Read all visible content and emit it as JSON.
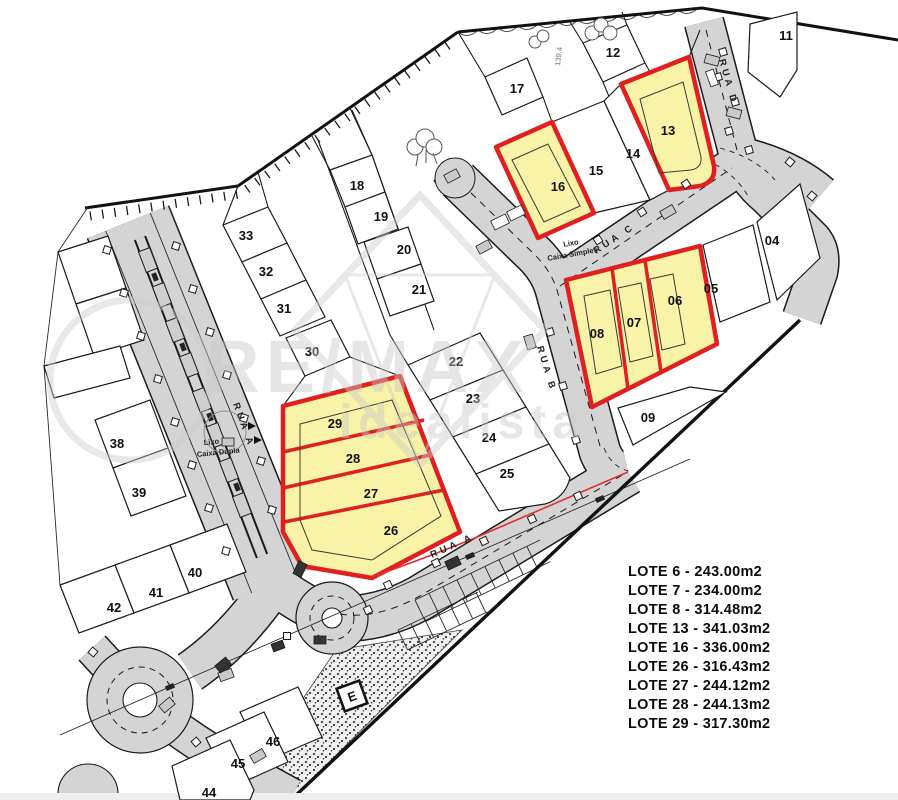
{
  "map": {
    "colors": {
      "highlight_fill": "#f8f3a6",
      "highlight_stroke": "#e02020",
      "road_fill": "#d4d4d4",
      "line": "#1b1b1b",
      "watermark": "#c9c9c9",
      "road_edge_red_line": "#e03030"
    },
    "lots": {
      "04": "04",
      "05": "05",
      "06": "06",
      "07": "07",
      "08": "08",
      "09": "09",
      "11": "11",
      "12": "12",
      "13": "13",
      "14": "14",
      "15": "15",
      "16": "16",
      "17": "17",
      "18": "18",
      "19": "19",
      "20": "20",
      "21": "21",
      "22": "22",
      "23": "23",
      "24": "24",
      "25": "25",
      "26": "26",
      "27": "27",
      "28": "28",
      "29": "29",
      "30": "30",
      "31": "31",
      "32": "32",
      "33": "33",
      "38": "38",
      "39": "39",
      "40": "40",
      "41": "41",
      "42": "42",
      "44": "44",
      "45": "45",
      "46": "46"
    },
    "highlighted_lots": [
      "06",
      "07",
      "08",
      "13",
      "16",
      "26",
      "27",
      "28",
      "29"
    ],
    "streets": {
      "rua_a": "RUA A",
      "rua_b": "RUA B",
      "rua_c": "RUA C",
      "rua_d": "RUA D"
    },
    "annotations": {
      "lixo_simples_line1": "Lixo",
      "lixo_simples_line2": "Caixa Simples",
      "lixo_dupla_line1": "Lixo",
      "lixo_dupla_line2": "Caixa Dupla",
      "elevation": "139.4",
      "transformer": "E"
    }
  },
  "watermark": {
    "brand": "RE/MAX",
    "portal": "idealista"
  },
  "legend": {
    "items": [
      "LOTE 6 - 243.00m2",
      "LOTE 7 - 234.00m2",
      "LOTE 8 - 314.48m2",
      "LOTE 13 - 341.03m2",
      "LOTE 16 - 336.00m2",
      "LOTE 26 - 316.43m2",
      "LOTE 27 - 244.12m2",
      "LOTE 28 - 244.13m2",
      "LOTE 29 - 317.30m2"
    ]
  }
}
